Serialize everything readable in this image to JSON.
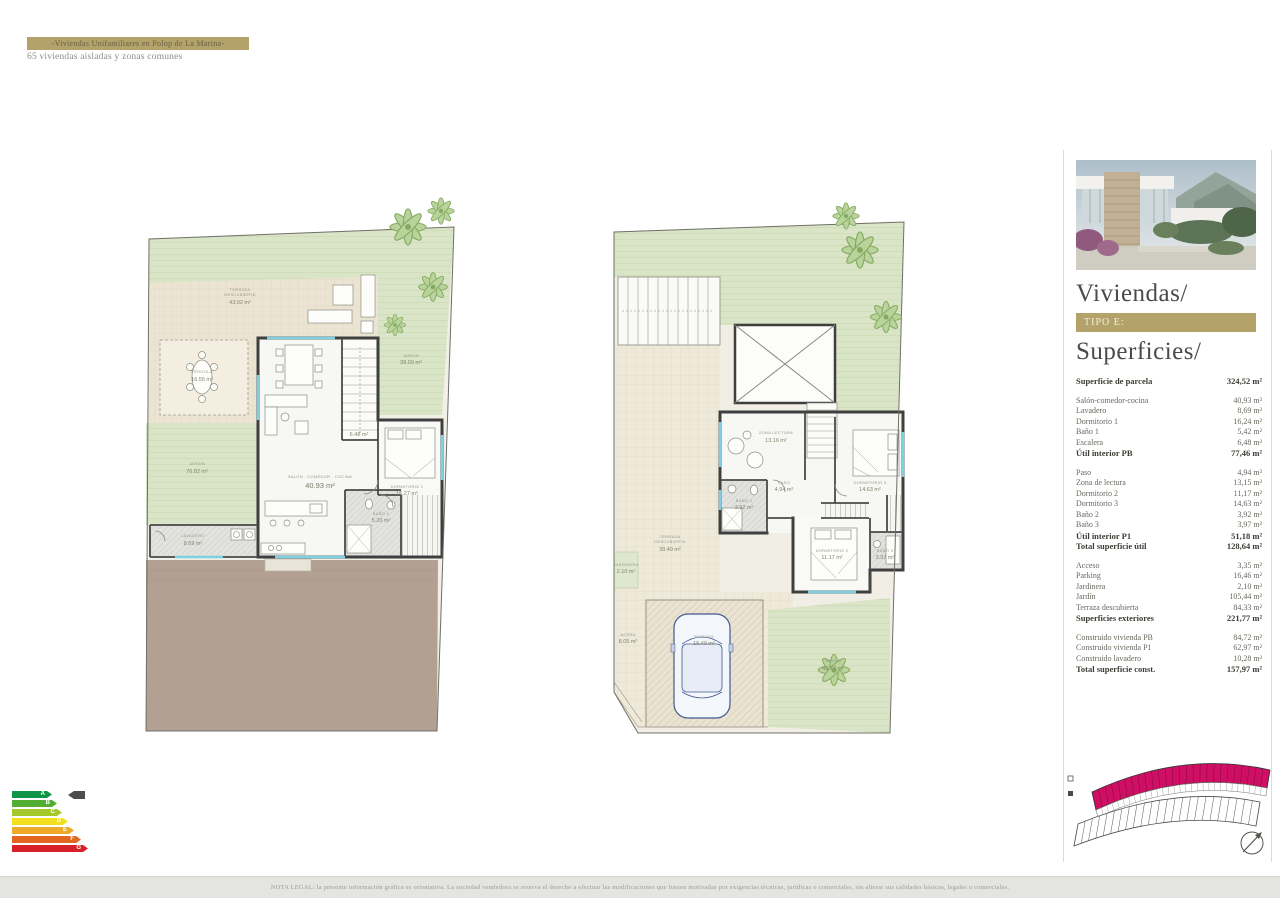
{
  "header": {
    "banner": "-Viviendas Unifamiliares en Polop de La Marina-",
    "subtitle": "65 viviendas aisladas y zonas comunes"
  },
  "sidebar": {
    "title": "Viviendas/",
    "type_badge": "TIPO E:",
    "surfaces_title": "Superficies/",
    "groups": [
      {
        "rows": [
          {
            "label": "Superficie de parcela",
            "value": "324,52 m²",
            "bold": true
          }
        ]
      },
      {
        "rows": [
          {
            "label": "Salón-comedor-cocina",
            "value": "40,93 m²"
          },
          {
            "label": "Lavadero",
            "value": "8,69 m²"
          },
          {
            "label": "Dormitorio 1",
            "value": "16,24 m²"
          },
          {
            "label": "Baño 1",
            "value": "5,42 m²"
          },
          {
            "label": "Escalera",
            "value": "6,48 m²"
          },
          {
            "label": "Útil interior PB",
            "value": "77,46 m²",
            "bold": true
          }
        ]
      },
      {
        "rows": [
          {
            "label": "Paso",
            "value": "4,94 m²"
          },
          {
            "label": "Zona de lectura",
            "value": "13,15 m²"
          },
          {
            "label": "Dormitorio 2",
            "value": "11,17 m²"
          },
          {
            "label": "Dormitorio 3",
            "value": "14,63 m²"
          },
          {
            "label": "Baño 2",
            "value": "3,92 m²"
          },
          {
            "label": "Baño 3",
            "value": "3,97 m²"
          },
          {
            "label": "Útil interior P1",
            "value": "51,18 m²",
            "bold": true
          },
          {
            "label": "Total superficie útil",
            "value": "128,64 m²",
            "bold": true
          }
        ]
      },
      {
        "rows": [
          {
            "label": "Acceso",
            "value": "3,35 m²"
          },
          {
            "label": "Parking",
            "value": "16,46 m²"
          },
          {
            "label": "Jardinera",
            "value": "2,10 m²"
          },
          {
            "label": "Jardín",
            "value": "105,44 m²"
          },
          {
            "label": "Terraza descubierta",
            "value": "84,33 m²"
          },
          {
            "label": "Superficies exteriores",
            "value": "221,77 m²",
            "bold": true
          }
        ]
      },
      {
        "rows": [
          {
            "label": "Construido vivienda PB",
            "value": "84,72 m²"
          },
          {
            "label": "Construido vivienda P1",
            "value": "62,97 m²"
          },
          {
            "label": "Construido lavadero",
            "value": "10,28 m²"
          },
          {
            "label": "Total superficie const.",
            "value": "157,97 m²",
            "bold": true
          }
        ]
      }
    ]
  },
  "plans": {
    "left": {
      "labels": {
        "terraza": {
          "l1": "TERRAZA",
          "l2": "DESCUBIERTA",
          "area": "43.02 m²"
        },
        "pergola": {
          "l1": "PÉRGOLA",
          "area": "16.55 m²"
        },
        "jardin_right": {
          "l1": "JARDIN",
          "area": "39.00 m²"
        },
        "jardin_left": {
          "l1": "JARDIN",
          "area": "76.82 m²"
        },
        "lavadero": {
          "l1": "LAVADERO",
          "area": "8.69 m²"
        },
        "salon": {
          "l1": "SALÓN - COMEDOR - COCINA",
          "area": "40.93 m²"
        },
        "dormitorio1": {
          "l1": "DORMITORIO 1",
          "area": "16.27 m²"
        },
        "bano1": {
          "l1": "BAÑO 1",
          "area": "5.20 m²"
        },
        "escalera": {
          "area": "6.48 m²"
        }
      }
    },
    "right": {
      "labels": {
        "zona_lectura": {
          "l1": "ZONA LECTURA",
          "area": "13.16 m²"
        },
        "paso": {
          "l1": "PASO",
          "area": "4.94 m²"
        },
        "dormitorio3": {
          "l1": "DORMITORIO 3",
          "area": "14.63 m²"
        },
        "bano2": {
          "l1": "BAÑO 2",
          "area": "3.92 m²"
        },
        "dormitorio2": {
          "l1": "DORMITORIO 2",
          "area": "11.17 m²"
        },
        "bano3": {
          "l1": "BAÑO 3",
          "area": "3.97 m²"
        },
        "terraza": {
          "l1": "TERRAZA",
          "l2": "DESCUBIERTA",
          "area": "39.40 m²"
        },
        "jardinera": {
          "l1": "JARDINERA",
          "area": "2.10 m²"
        },
        "acera": {
          "l1": "ACERA",
          "area": "8.05 m²"
        },
        "parking": {
          "l1": "PARKING",
          "area": "15.40 m²"
        },
        "jardin": {
          "l1": "JARDIN",
          "area": "43.77 m²"
        }
      }
    }
  },
  "energy": {
    "grades": [
      {
        "letter": "A",
        "color": "#0f9547"
      },
      {
        "letter": "B",
        "color": "#52ae32"
      },
      {
        "letter": "C",
        "color": "#a5c92c"
      },
      {
        "letter": "D",
        "color": "#f2e01f"
      },
      {
        "letter": "E",
        "color": "#eda928"
      },
      {
        "letter": "F",
        "color": "#e2661f"
      },
      {
        "letter": "G",
        "color": "#d71f27"
      }
    ],
    "pointer_color": "#4d4d4d"
  },
  "siteplan": {
    "highlight_color": "#cf0f63",
    "outline_color": "#3a3a3a"
  },
  "footer": {
    "legal": "NOTA LEGAL: la presente información gráfica es orientativa. La sociedad vendedora se reserva el derecho a efectuar las modificaciones que fuesen motivadas por exigencias técnicas, jurídicas o comerciales, sin alterar sus calidades básicas, legales o comerciales."
  }
}
